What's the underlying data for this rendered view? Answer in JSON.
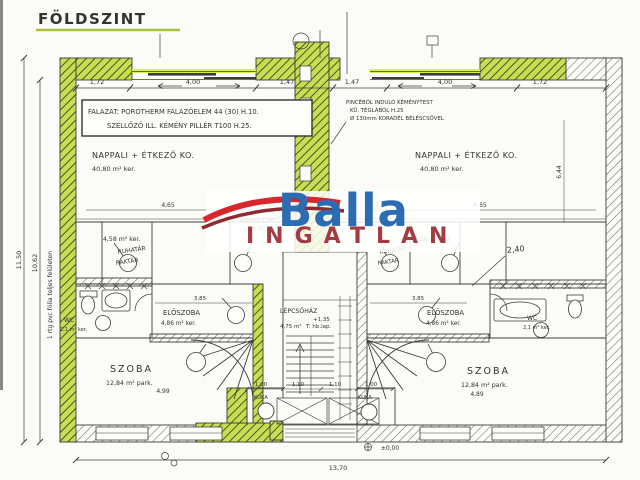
{
  "page": {
    "title": "FÖLDSZINT"
  },
  "watermark": {
    "brand": "Balla",
    "word": "INGATLAN",
    "brand_color": "#2b6cb3",
    "word_color": "#a23c42",
    "swoosh_color": "#d8262c"
  },
  "colors": {
    "highlight": "#c7de52",
    "ink": "#3c3c3c",
    "paper": "#fbfbf8"
  },
  "notes": {
    "spec_line1": "FALAZAT: POROTHERM FALAZÓELEM 44 (30) H.10.",
    "spec_line2": "SZELLŐZŐ ILL. KÉMÉNY PILLÉR T100 H.25.",
    "chimney_line1": "PINCÉBŐL INDULÓ KÉMÉNYTEST",
    "chimney_line2": "KÜ. TÉGLÁBÓL H.25",
    "chimney_line3": "Ø 130mm KORADÉL BÉLÉSCSŐVEL",
    "membrane": "1 rtg pvc fólia teljes felületen",
    "vent_shaft": "szellőző akna",
    "vent_level": "+4,50"
  },
  "rooms": {
    "living_left": {
      "name": "NAPPALI + ÉTKEZŐ KO.",
      "area": "40,80 m² ker."
    },
    "living_right": {
      "name": "NAPPALI + ÉTKEZŐ KO.",
      "area": "40,80 m² ker."
    },
    "storage_left": {
      "area": "4,58 m² ker.",
      "line1": "RUHATÁR",
      "line2": "RAKTÁR"
    },
    "storage_right": {
      "area": "4,56 m² ker.",
      "line1": "RUHATÁR",
      "line2": "RAKTÁR"
    },
    "hall_left": {
      "name": "ELŐSZOBA",
      "area": "4,86 m² ker."
    },
    "hall_right": {
      "name": "ELŐSZOBA",
      "area": "4,86 m² ker."
    },
    "wc_left": {
      "name": "WC",
      "area": "2,1 m² ker."
    },
    "wc_right": {
      "name": "WC",
      "area": "2,1 m² ker."
    },
    "stairs": {
      "name": "LÉPCSŐHÁZ",
      "level": "+1,35",
      "area": "4,75 m²",
      "note": "T: hb.lap."
    },
    "bedroom_left": {
      "name": "SZOBA",
      "area": "12,84 m² park."
    },
    "bedroom_right": {
      "name": "SZOBA",
      "area": "12,84 m² park."
    },
    "bin_left": "KUKA",
    "bin_right": "KUKA"
  },
  "dims": {
    "top": [
      "1,72",
      "4,00",
      "1,47",
      "1,47",
      "4,00",
      "1,72"
    ],
    "left_outer": "11,50",
    "left_inner": "10,62",
    "living_left": [
      "4,65",
      "2,40"
    ],
    "living_right": [
      "2,40",
      "4,65"
    ],
    "closet_right": "2,40",
    "right_vertical": "6,44",
    "hall_left": "3,85",
    "hall_right": "3,85",
    "bedroom_left": "4,99",
    "bedroom_right": "4,89",
    "porch": [
      "1,00",
      "1,10",
      "1,10",
      "1,00"
    ],
    "total_width": "13,70",
    "level_zero": "±0,00"
  }
}
